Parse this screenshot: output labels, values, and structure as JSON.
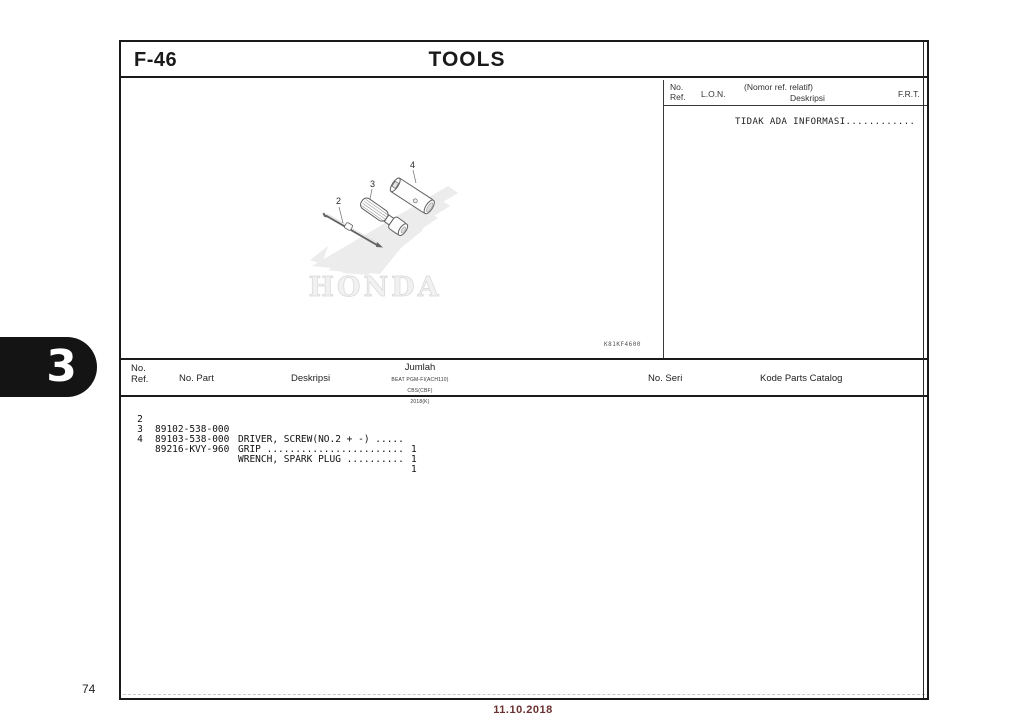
{
  "page": {
    "section_code": "F-46",
    "title": "TOOLS",
    "tab_number": "3",
    "page_number": "74",
    "footer_date": "11.10.2018",
    "watermark": "HONDA",
    "image_code": "K81KF4600"
  },
  "colors": {
    "footer_date": "#6b3030",
    "tab_bg": "#141414"
  },
  "info_panel": {
    "headers": {
      "no": "No.",
      "ref": "Ref.",
      "lon": "L.O.N.",
      "nomor_ref": "(Nomor ref. relatif)",
      "deskripsi": "Deskripsi",
      "frt": "F.R.T."
    },
    "message": "TIDAK ADA INFORMASI............"
  },
  "parts_table": {
    "headers": {
      "no": "No.",
      "ref": "Ref.",
      "part": "No. Part",
      "deskripsi": "Deskripsi",
      "jumlah": "Jumlah",
      "jumlah_sub1": "BEAT PGM-FI(ACH110)",
      "jumlah_sub2": "CBS(CBF)",
      "jumlah_sub3": "2018(K)",
      "seri": "No. Seri",
      "kode": "Kode Parts Catalog"
    },
    "rows": [
      {
        "ref": "2",
        "part": "89102-538-000",
        "desc": "DRIVER, SCREW(NO.2 + -) .....",
        "qty": "1"
      },
      {
        "ref": "3",
        "part": "89103-538-000",
        "desc": "GRIP ........................",
        "qty": "1"
      },
      {
        "ref": "4",
        "part": "89216-KVY-960",
        "desc": "WRENCH, SPARK PLUG ..........",
        "qty": "1"
      }
    ]
  },
  "diagram": {
    "labels": {
      "l2": "2",
      "l3": "3",
      "l4": "4"
    }
  }
}
